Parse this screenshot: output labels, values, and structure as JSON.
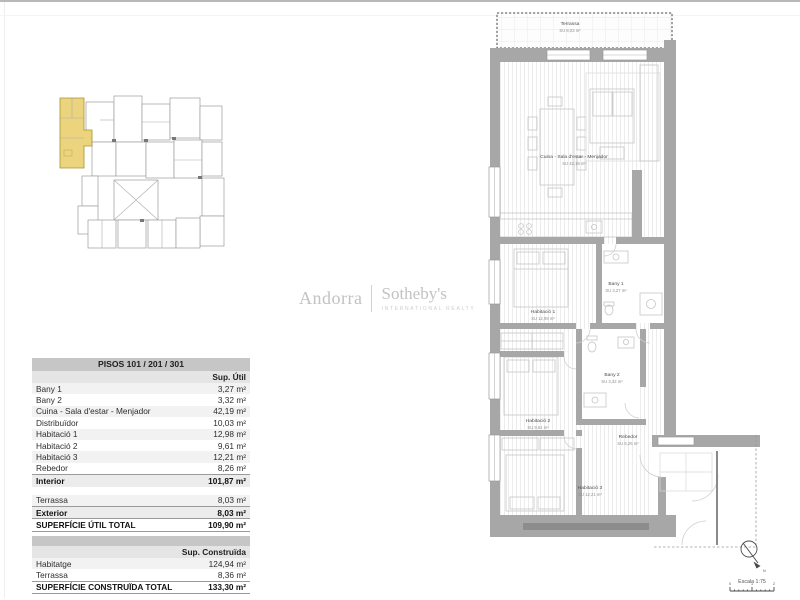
{
  "logo": {
    "left": "Andorra",
    "right": "Sotheby's",
    "subtitle": "INTERNATIONAL REALTY"
  },
  "tables": {
    "util": {
      "title": "PISOS 101 / 201 / 301",
      "header": "Sup. Útil",
      "rows": [
        {
          "label": "Bany 1",
          "value": "3,27 m²"
        },
        {
          "label": "Bany 2",
          "value": "3,32 m²"
        },
        {
          "label": "Cuina - Sala d'estar - Menjador",
          "value": "42,19 m²"
        },
        {
          "label": "Distribuïdor",
          "value": "10,03 m²"
        },
        {
          "label": "Habitació 1",
          "value": "12,98 m²"
        },
        {
          "label": "Habitació 2",
          "value": "9,61 m²"
        },
        {
          "label": "Habitació 3",
          "value": "12,21 m²"
        },
        {
          "label": "Rebedor",
          "value": "8,26 m²"
        }
      ],
      "interior": {
        "label": "Interior",
        "value": "101,87 m²"
      },
      "exterior_rows": [
        {
          "label": "Terrassa",
          "value": "8,03 m²"
        }
      ],
      "exterior": {
        "label": "Exterior",
        "value": "8,03 m²"
      },
      "total": {
        "label": "SUPERFÍCIE ÚTIL TOTAL",
        "value": "109,90 m²"
      }
    },
    "construida": {
      "header": "Sup. Construïda",
      "rows": [
        {
          "label": "Habitatge",
          "value": "124,94 m²"
        },
        {
          "label": "Terrassa",
          "value": "8,36 m²"
        }
      ],
      "total": {
        "label": "SUPERFÍCIE CONSTRUÏDA TOTAL",
        "value": "133,30 m²"
      }
    }
  },
  "floor_plan": {
    "rooms": [
      {
        "name": "Terrassa",
        "area": "SU 8,03 m²"
      },
      {
        "name": "Cuina - Sala d'estar - Menjador",
        "area": "SU 42,19 m²"
      },
      {
        "name": "Habitació 1",
        "area": "SU 12,98 m²"
      },
      {
        "name": "Bany 1",
        "area": "SU 3,27 m²"
      },
      {
        "name": "Habitació 2",
        "area": "SU 9,61 m²"
      },
      {
        "name": "Bany 2",
        "area": "SU 3,32 m²"
      },
      {
        "name": "Habitació 3",
        "area": "SU 12,21 m²"
      },
      {
        "name": "Rebedor",
        "area": "SU 8,26 m²"
      }
    ],
    "wall_color": "#a7a7a7",
    "highlight_color": "#ecd47e"
  },
  "scale": {
    "label": "Escala 1:75",
    "north": "N",
    "ticks": [
      "0",
      "1",
      "2"
    ]
  }
}
